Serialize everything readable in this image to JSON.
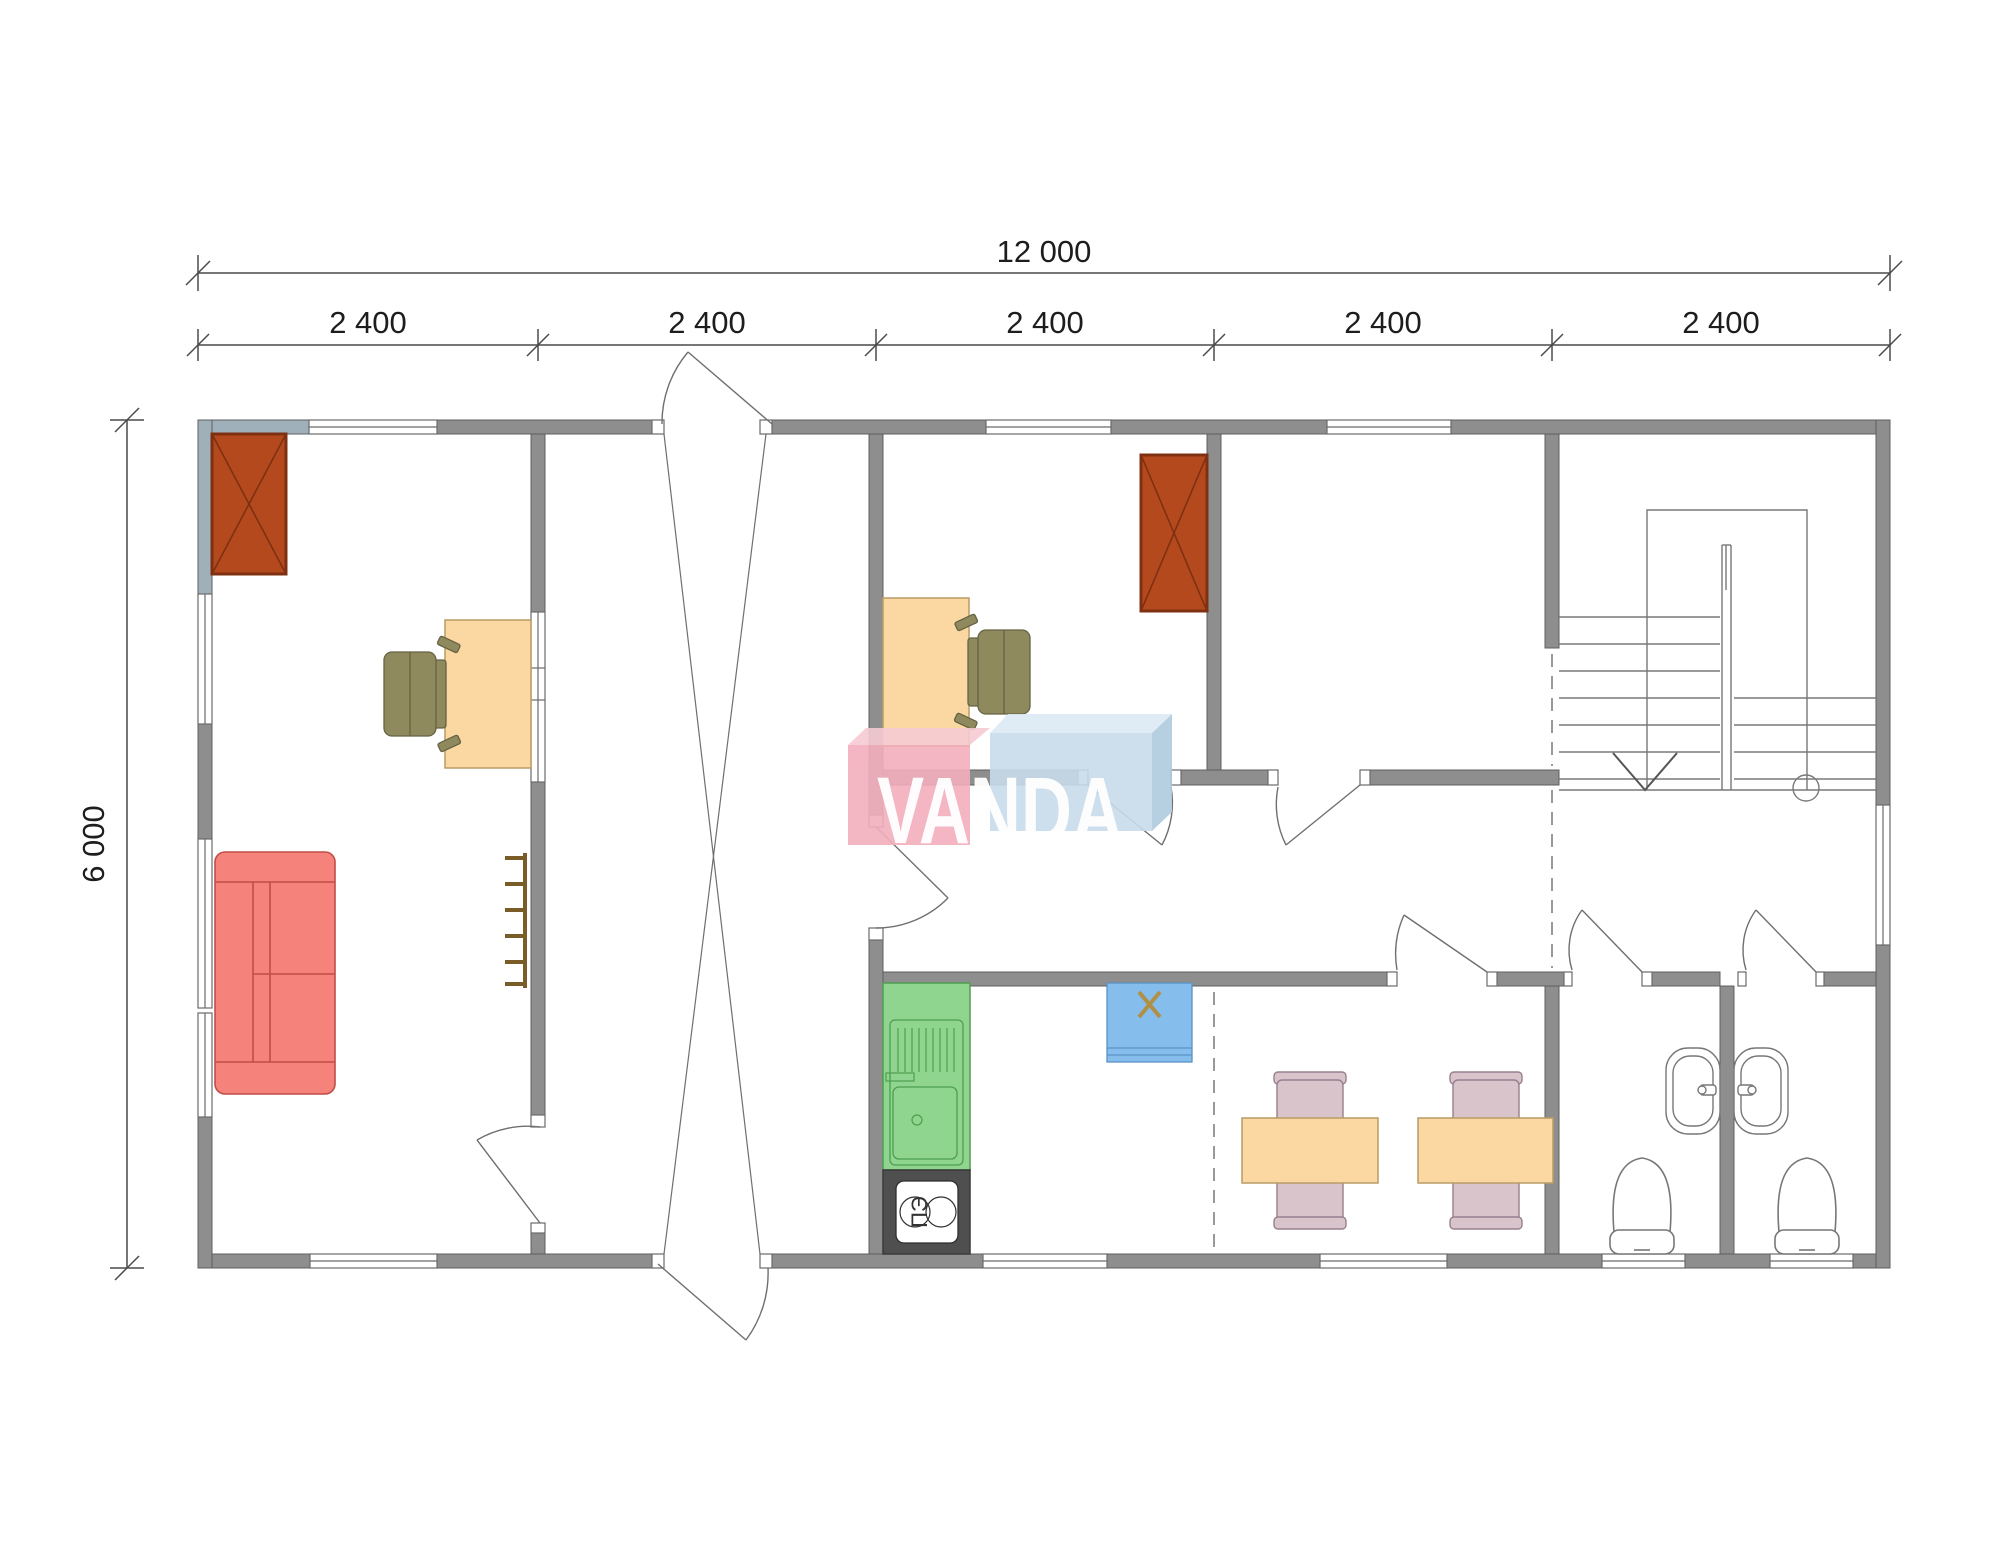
{
  "watermark": {
    "brand": "VANDA"
  },
  "dimensions": {
    "total_width": {
      "label": "12 000"
    },
    "total_height": {
      "label": "6 000"
    },
    "segments": [
      {
        "label": "2 400"
      },
      {
        "label": "2 400"
      },
      {
        "label": "2 400"
      },
      {
        "label": "2 400"
      },
      {
        "label": "2 400"
      }
    ]
  },
  "labels": {
    "electric_stove": "ПЭ"
  },
  "colors": {
    "wall": "#8E8E8E",
    "wall_outline": "#5F5F5F",
    "wall_tinted": "#9FB0BA",
    "stove": "#B4491E",
    "stove_border": "#7E3011",
    "desk": "#FBD8A1",
    "desk_border": "#B99B66",
    "chair_olive": "#8F8A5E",
    "sofa": "#F5837B",
    "sofa_line": "#C14D47",
    "kitchen_green": "#8FD48F",
    "kitchen_green_line": "#4E9E50",
    "electric_stove_dark": "#4F4F4F",
    "appliance_blue": "#85BEEC",
    "appliance_x_mark": "#B09046",
    "dining_chair": "#D9C4CC",
    "dining_chair_border": "#97808E",
    "watermark_pink": "#F2AFBC",
    "watermark_pink_top": "#F7CBD3",
    "watermark_blue": "#C8DCEB",
    "watermark_blue_top": "#DCEAF5",
    "watermark_blue_side": "#AFCCDE",
    "dashed_joint": "#999999",
    "dimension_lines": "#4a4a4a"
  },
  "icons": {
    "wood_stove": "crossed-box",
    "staircase": "treads-with-down-arrow",
    "door": "leaf-and-arc",
    "window": "white-bar-in-wall"
  }
}
